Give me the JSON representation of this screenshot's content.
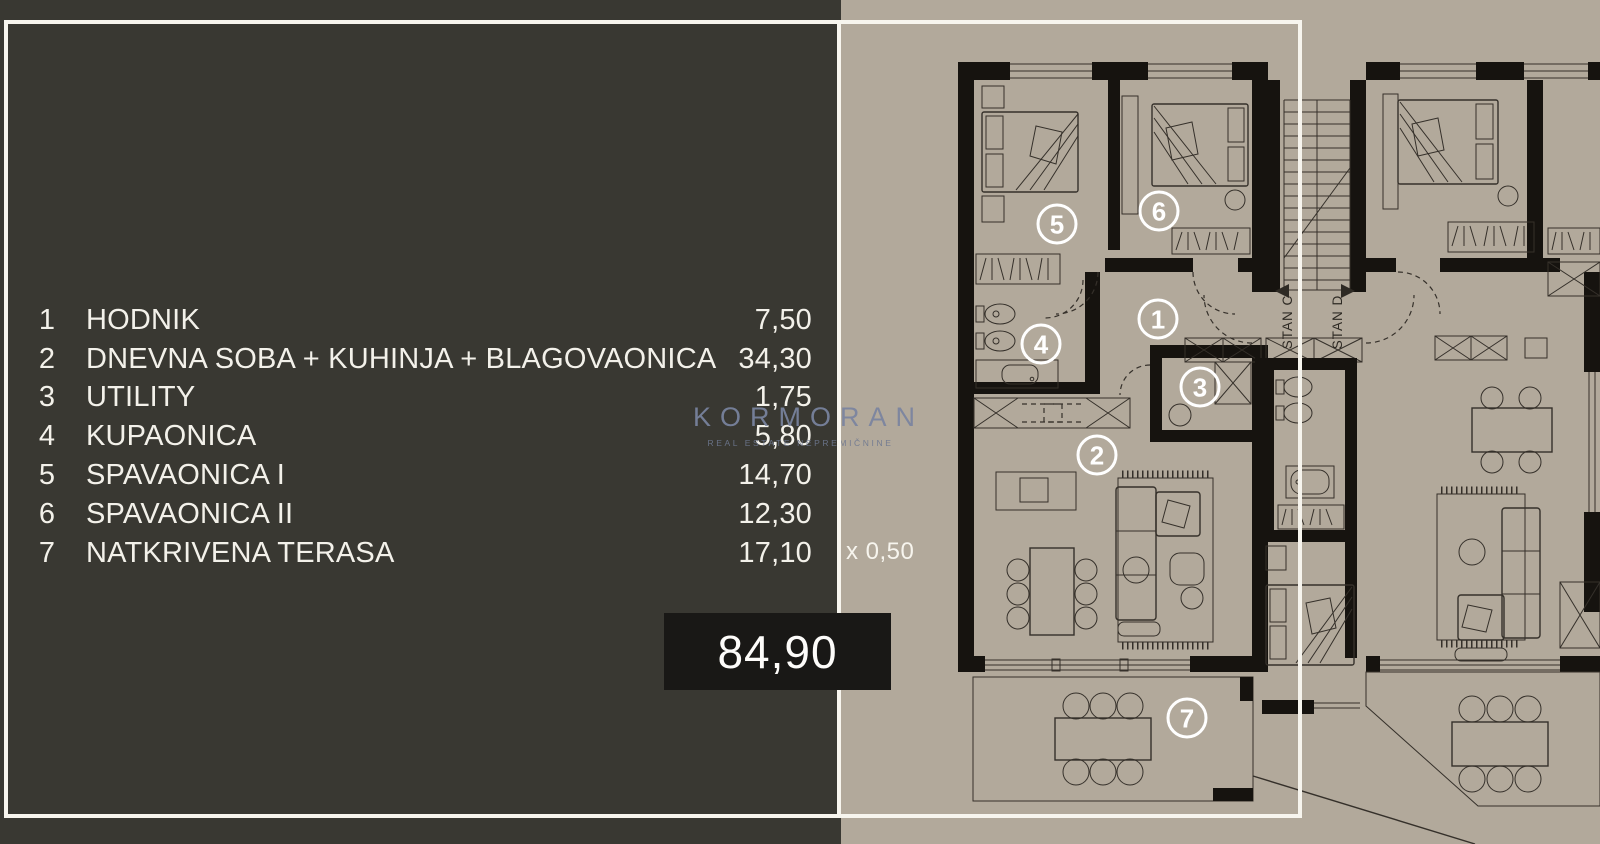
{
  "colors": {
    "panel_bg": "#393832",
    "floor_bg": "#b2a99b",
    "plan_line": "#35302a",
    "wall": "#16130f",
    "frame_white": "#f7f5ee",
    "total_box_bg": "#191816",
    "text_white": "#f3f1ea",
    "watermark": "#7a84a0"
  },
  "legend": {
    "rows": [
      {
        "num": "1",
        "name": "HODNIK",
        "area": "7,50"
      },
      {
        "num": "2",
        "name": "DNEVNA SOBA + KUHINJA + BLAGOVAONICA",
        "area": "34,30"
      },
      {
        "num": "3",
        "name": "UTILITY",
        "area": "1,75"
      },
      {
        "num": "4",
        "name": "KUPAONICA",
        "area": "5,80"
      },
      {
        "num": "5",
        "name": "SPAVAONICA I",
        "area": "14,70"
      },
      {
        "num": "6",
        "name": "SPAVAONICA II",
        "area": "12,30"
      },
      {
        "num": "7",
        "name": "NATKRIVENA TERASA",
        "area": "17,10"
      }
    ],
    "multiplier": "x 0,50",
    "total": "84,90"
  },
  "watermark": {
    "brand": "KORMORAN",
    "tagline": "REAL ESTATE NEPREMIČNINE"
  },
  "plan": {
    "unit_markers": [
      {
        "label": "1",
        "x": 1158,
        "y": 319
      },
      {
        "label": "2",
        "x": 1097,
        "y": 455
      },
      {
        "label": "3",
        "x": 1200,
        "y": 387
      },
      {
        "label": "4",
        "x": 1041,
        "y": 344
      },
      {
        "label": "5",
        "x": 1057,
        "y": 224
      },
      {
        "label": "6",
        "x": 1159,
        "y": 211
      },
      {
        "label": "7",
        "x": 1187,
        "y": 718
      }
    ],
    "stan_labels": [
      {
        "label": "STAN C",
        "text_x": 1292,
        "text_y": 322,
        "tri_x": 1283,
        "tri_y": 291,
        "dir": "left"
      },
      {
        "label": "STAN D",
        "text_x": 1342,
        "text_y": 322,
        "tri_x": 1347,
        "tri_y": 291,
        "dir": "right"
      }
    ]
  }
}
